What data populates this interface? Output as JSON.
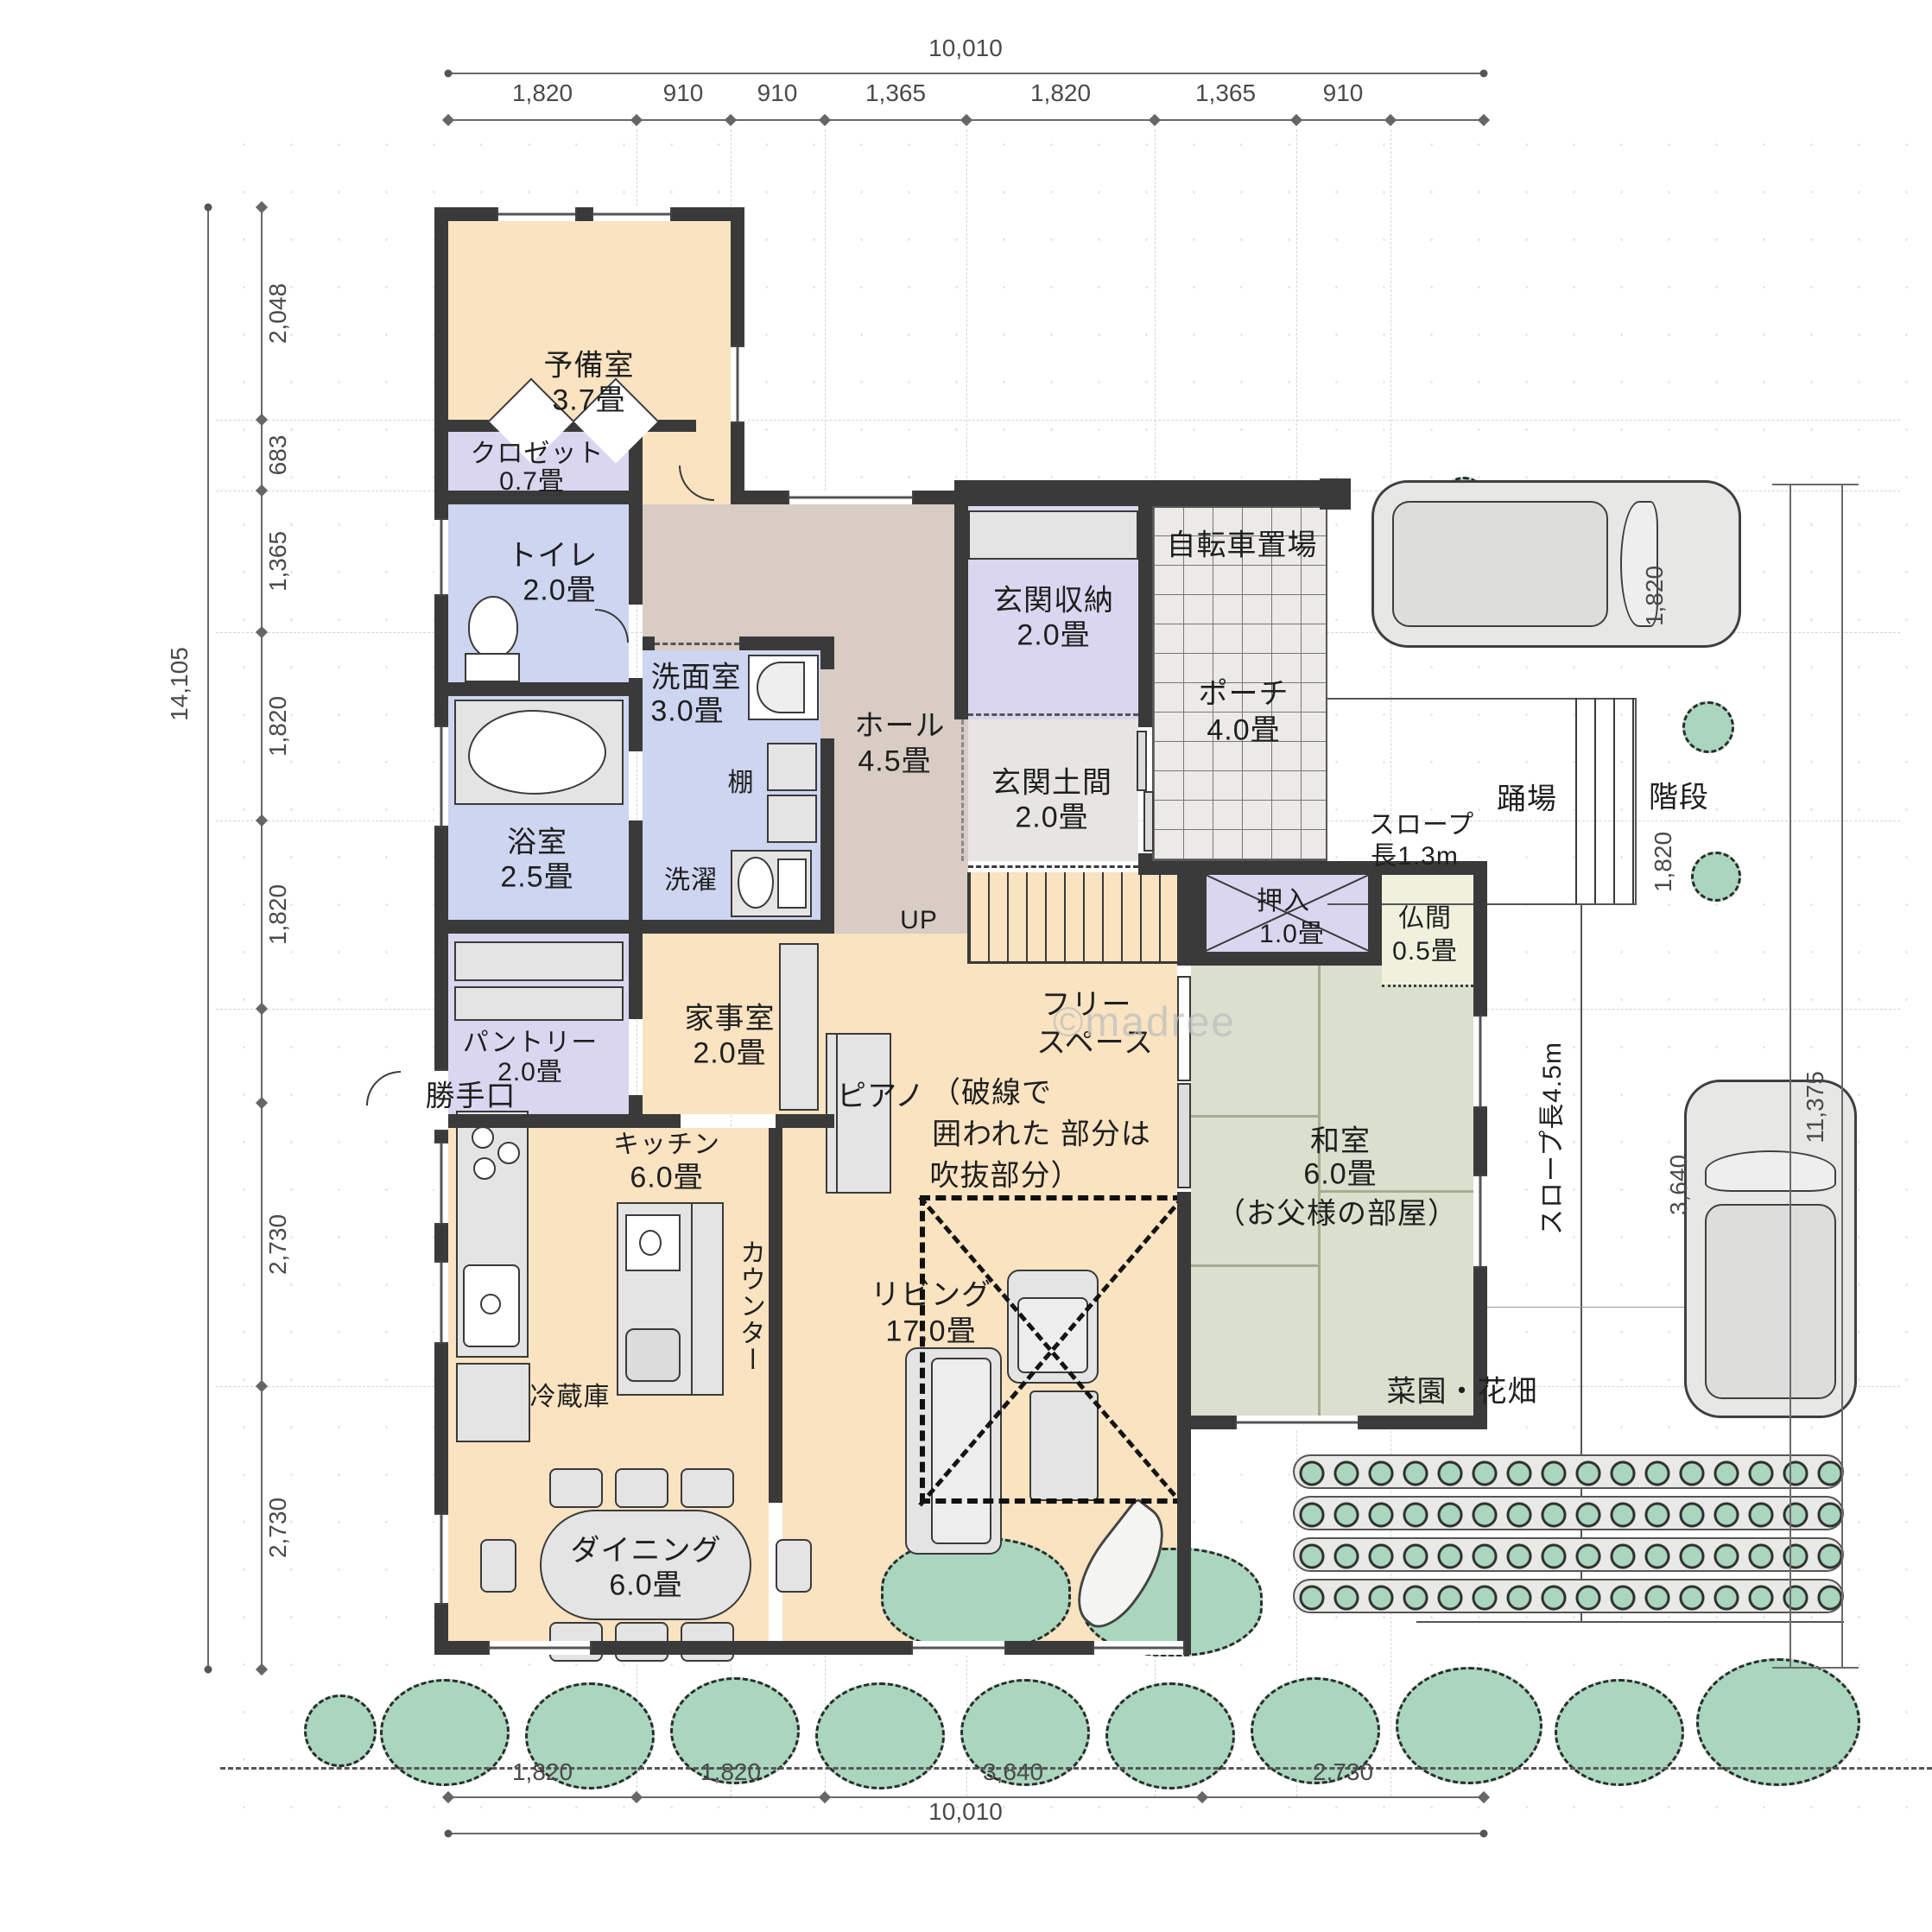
{
  "watermark": "©madree",
  "palette": {
    "wall": "#3a3a3a",
    "floor_wood": "#fae3c1",
    "floor_lavender": "#dbd6ef",
    "floor_blue": "#cdd5f0",
    "floor_hall": "#d8ccc4",
    "floor_doma": "#e7e5e2",
    "tatami_green": "#d9e0cd",
    "butsuma": "#eff1dd",
    "plants_green": "#a9d6bd"
  },
  "dims": {
    "top_total": "10,010",
    "top_segments": [
      "1,820",
      "910",
      "910",
      "1,365",
      "1,820",
      "1,365",
      "910"
    ],
    "left_total": "14,105",
    "left_segments": [
      "2,048",
      "683",
      "1,365",
      "1,820",
      "1,820",
      "2,730",
      "2,730"
    ],
    "bottom_segments": [
      "1,820",
      "1,820",
      "3,640",
      "2,730"
    ],
    "bottom_total": "10,010",
    "right_total": "11,375",
    "right_side": [
      "3,640",
      "1,820",
      "1,820"
    ]
  },
  "rooms": {
    "yobishitsu": {
      "name": "予備室",
      "size": "3.7畳"
    },
    "closet": {
      "name": "クロゼット",
      "size": "0.7畳"
    },
    "toilet": {
      "name": "トイレ",
      "size": "2.0畳"
    },
    "bath": {
      "name": "浴室",
      "size": "2.5畳"
    },
    "senmen": {
      "name": "洗面室",
      "size": "3.0畳"
    },
    "pantry": {
      "name": "パントリー",
      "size": "2.0畳"
    },
    "kaji": {
      "name": "家事室",
      "size": "2.0畳"
    },
    "hall": {
      "name": "ホール",
      "size": "4.5畳"
    },
    "genkan_shuno": {
      "name": "玄関収納",
      "size": "2.0畳"
    },
    "genkan_doma": {
      "name": "玄関土間",
      "size": "2.0畳"
    },
    "porch": {
      "name": "ポーチ",
      "size": "4.0畳"
    },
    "oshiire": {
      "name": "押入",
      "size": "1.0畳"
    },
    "butsuma": {
      "name": "仏間",
      "size": "0.5畳"
    },
    "free_space": {
      "line1": "フリー",
      "line2": "スペース"
    },
    "washitsu": {
      "name": "和室",
      "size": "6.0畳",
      "note": "（お父様の部屋）"
    },
    "living": {
      "name": "リビング",
      "size": "17.0畳"
    },
    "kitchen": {
      "name": "キッチン",
      "size": "6.0畳"
    },
    "dining": {
      "name": "ダイニング",
      "size": "6.0畳"
    }
  },
  "labels": {
    "bicycle": "自転車置場",
    "slope13_1": "スロープ",
    "slope13_2": "長1.3m",
    "slope45": "スロープ長4.5m",
    "odoriba": "踊場",
    "kaidan": "階段",
    "up": "UP",
    "tana": "棚",
    "sentaku": "洗濯",
    "katteguchi": "勝手口",
    "reizoko": "冷蔵庫",
    "counter": "カウンター",
    "piano": "ピアノ",
    "garden": "菜園・花畑",
    "void1": "（破線で",
    "void2": "囲われた 部分は",
    "void3": "吹抜部分）"
  }
}
